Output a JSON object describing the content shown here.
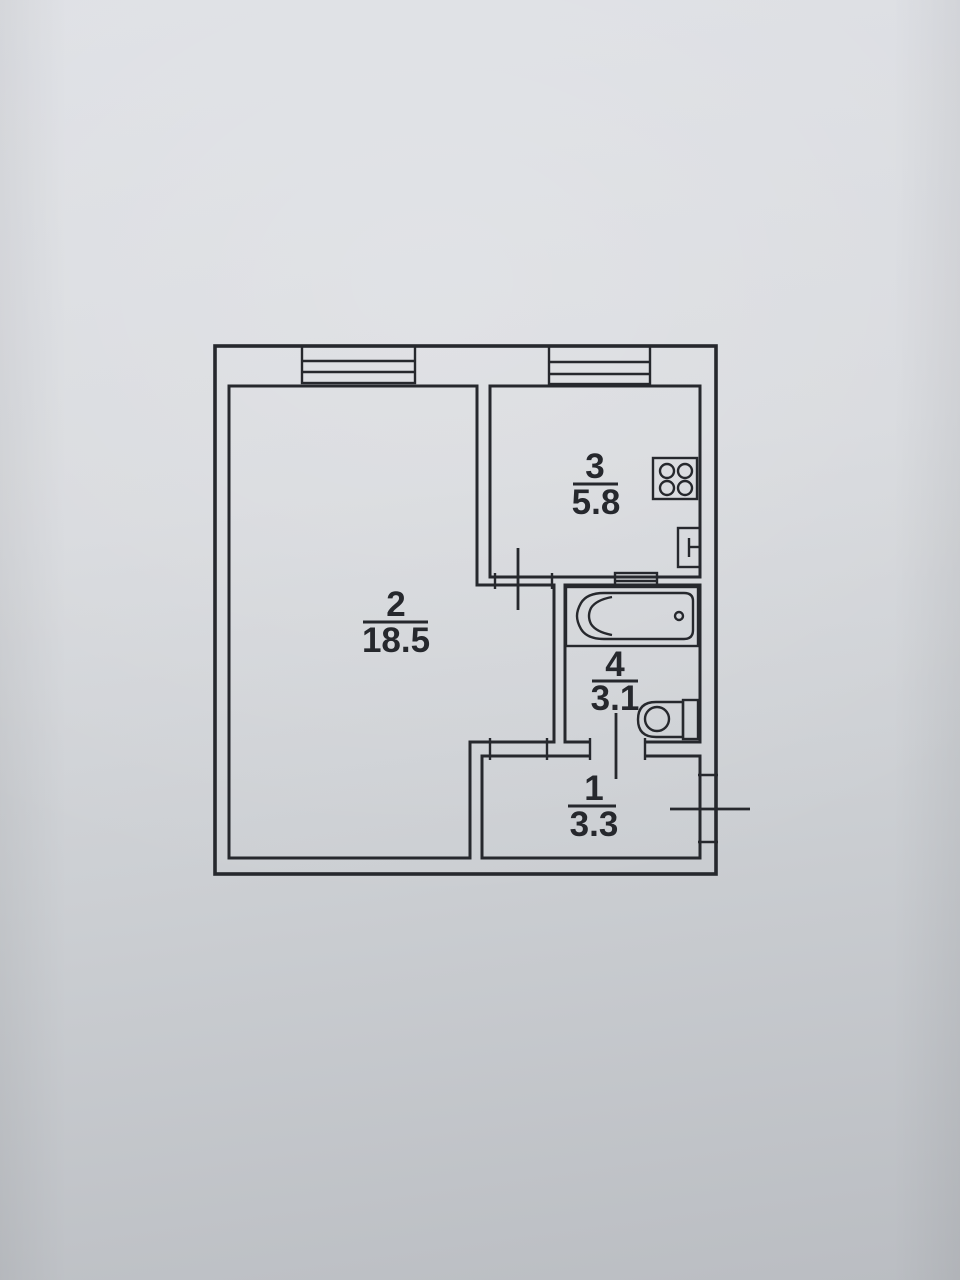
{
  "document": {
    "kind": "apartment floor plan (photographed paper drawing)",
    "total_rooms_labeled": 4
  },
  "palette": {
    "paper_light": "#dddfe4",
    "paper_dark": "#babdc2",
    "ink": "#26282d"
  },
  "plan": {
    "rooms": [
      {
        "key": "living",
        "number": "2",
        "area": "18.5"
      },
      {
        "key": "kitchen",
        "number": "3",
        "area": "5.8"
      },
      {
        "key": "bathroom",
        "number": "4",
        "area": "3.1"
      },
      {
        "key": "hallway",
        "number": "1",
        "area": "3.3"
      }
    ],
    "fixtures": [
      "window",
      "window",
      "stove-4-burner",
      "kitchen-sink",
      "vent-duct",
      "bathtub",
      "bathtub-drain",
      "toilet-with-tank",
      "kitchen-door",
      "bathroom-door",
      "room-opening",
      "entrance-door"
    ]
  }
}
